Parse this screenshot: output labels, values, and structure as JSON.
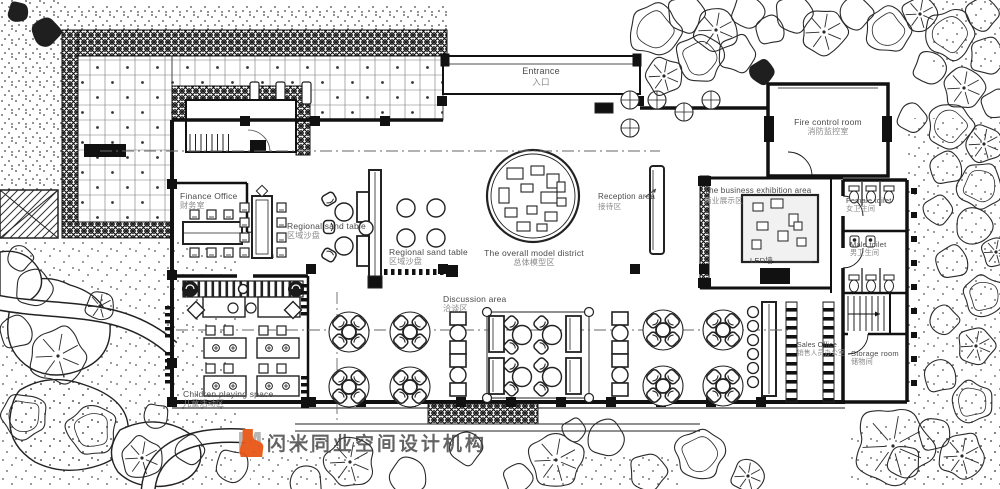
{
  "labels": {
    "entrance": {
      "en": "Entrance",
      "zh": "入口"
    },
    "fire_control": {
      "en": "Fire control room",
      "zh": "消防监控室"
    },
    "business_exhibition": {
      "en": "The business exhibition area",
      "zh": "商业展示区"
    },
    "female_toilet": {
      "en": "Female toilet",
      "zh": "女卫生间"
    },
    "male_toilet": {
      "en": "Male toilet",
      "zh": "男卫生间"
    },
    "reception": {
      "en": "Reception area",
      "zh": "接待区"
    },
    "overall_model": {
      "en": "The overall model district",
      "zh": "总体模型区"
    },
    "regional_sand_1": {
      "en": "Regional sand table",
      "zh": "区域沙盘"
    },
    "regional_sand_2": {
      "en": "Regional sand table",
      "zh": "区域沙盘"
    },
    "finance_office": {
      "en": "Finance Office",
      "zh": "财务室"
    },
    "discussion": {
      "en": "Discussion area",
      "zh": "洽谈区"
    },
    "children": {
      "en": "Children playing space",
      "zh": "儿童活动区"
    },
    "sales_office": {
      "en": "Sales Office",
      "zh": "销售人员办公室"
    },
    "storage": {
      "en": "Storage room",
      "zh": "储物间"
    },
    "led_wall": {
      "en": "LED墙"
    }
  },
  "logo": {
    "mark": "M",
    "name": "闪米同业空间设计机构",
    "accent": "#e8520f"
  },
  "colors": {
    "accent": "#e8520f",
    "ink": "#1a1a1a",
    "label": "#4a4a4a"
  }
}
